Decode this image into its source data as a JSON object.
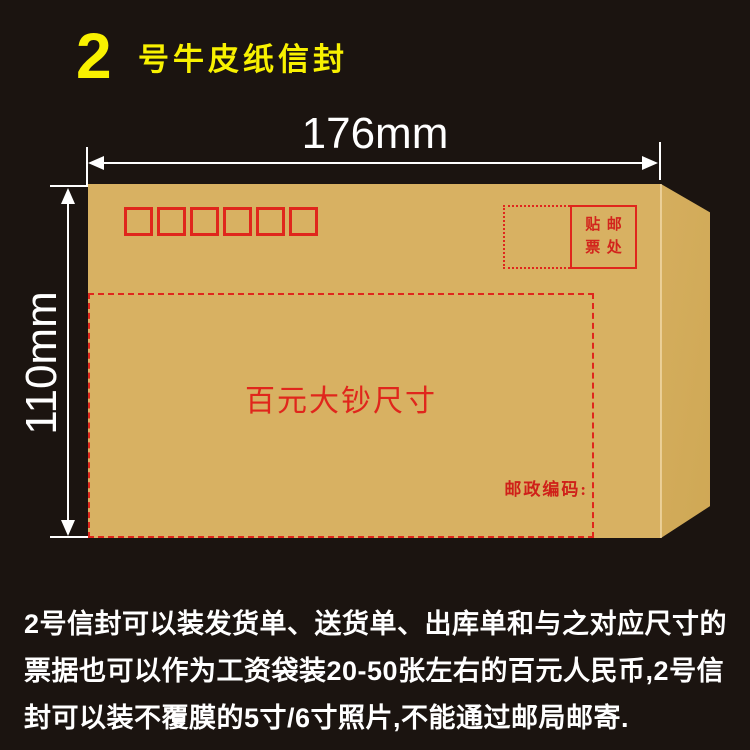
{
  "page": {
    "background_color": "#1b1410"
  },
  "header": {
    "size_number": "2",
    "title": "号牛皮纸信封",
    "accent_color": "#f8f100"
  },
  "dimensions": {
    "width_label": "176mm",
    "height_label": "110mm",
    "annotation_color": "#ffffff"
  },
  "envelope": {
    "paper_color": "#d8b162",
    "print_color": "#e0261c",
    "postal_code_box_count": 6,
    "stamp_area": {
      "chars": [
        "贴",
        "邮",
        "票",
        "处"
      ]
    },
    "bill_area_label": "百元大钞尺寸",
    "postcode_label": "邮政编码:"
  },
  "description": {
    "lines": [
      "2号信封可以装发货单、送货单、出库单和与之对应尺寸的",
      "票据也可以作为工资袋装20-50张左右的百元人民币,2号信",
      "封可以装不覆膜的5寸/6寸照片,不能通过邮局邮寄."
    ]
  }
}
